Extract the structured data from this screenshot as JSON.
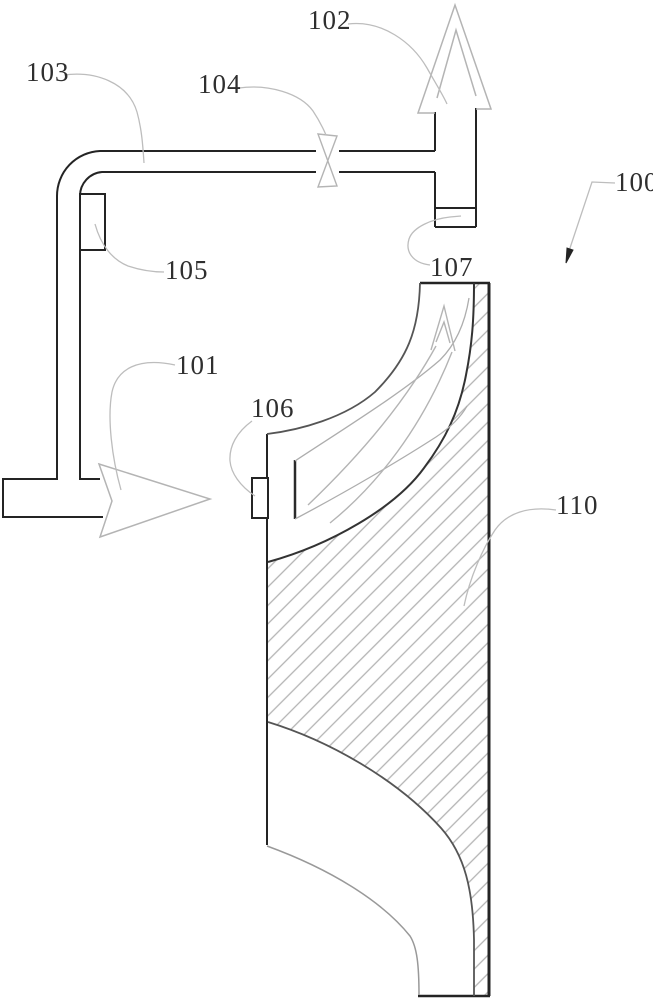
{
  "figure": {
    "type": "patent-technical-drawing",
    "labels": [
      {
        "id": "102",
        "text": "102",
        "x": 308,
        "y": 7
      },
      {
        "id": "103",
        "text": "103",
        "x": 26,
        "y": 59
      },
      {
        "id": "104",
        "text": "104",
        "x": 198,
        "y": 71
      },
      {
        "id": "100",
        "text": "100",
        "x": 615,
        "y": 169
      },
      {
        "id": "105",
        "text": "105",
        "x": 165,
        "y": 257
      },
      {
        "id": "107",
        "text": "107",
        "x": 430,
        "y": 254
      },
      {
        "id": "101",
        "text": "101",
        "x": 176,
        "y": 352
      },
      {
        "id": "106",
        "text": "106",
        "x": 251,
        "y": 395
      },
      {
        "id": "110",
        "text": "110",
        "x": 556,
        "y": 492
      }
    ],
    "colors": {
      "line": "#242424",
      "mid_line": "#555555",
      "soft_line": "#999999",
      "sketch": "#b4b4b4",
      "leader": "#bdbdbd",
      "hatch": "#b3b3b3",
      "text": "#2f2f2f",
      "background": "#ffffff"
    }
  }
}
